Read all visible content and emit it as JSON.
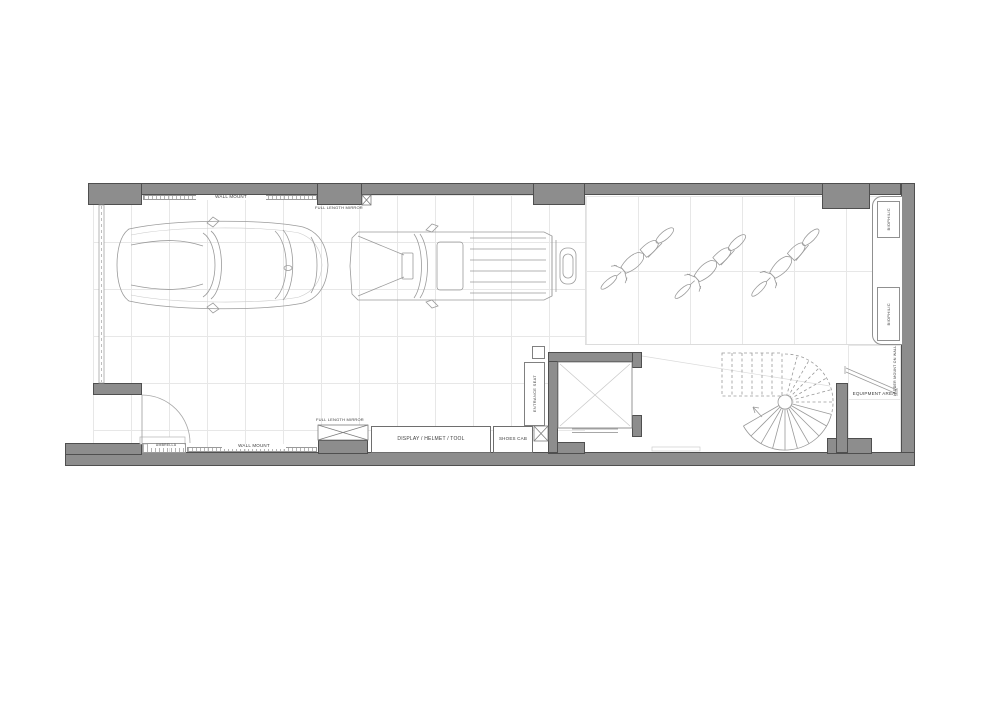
{
  "title": "Garage floor plan",
  "colors": {
    "wall": "#8d8d8d",
    "wall_outline": "#4f4f4f",
    "drawing_line": "#9b9b9b",
    "tile_line": "#e7e7e7",
    "label_text": "#3d3d3d",
    "background": "#ffffff"
  },
  "plan": {
    "top": {
      "wall_mount": "WALL MOUNT",
      "mirror": "FULL LENGTH MIRROR"
    },
    "bottom": {
      "umbrella": "UMBRELLA",
      "wall_mount": "WALL MOUNT",
      "mirror": "FULL LENGTH MIRROR",
      "display_cab": "DISPLAY / HELMET / TOOL",
      "shoes_cab": "SHOES CAB"
    },
    "entrance": {
      "seat": "ENTRANCE SEAT"
    },
    "right": {
      "planters": [
        "BIOPHILIC",
        "BIOPHILIC"
      ],
      "equipment_area": "EQUIPMENT AREA",
      "ladder": "LADDER MOUNT ON WALL"
    },
    "vehicles": [
      "sedan",
      "suv",
      "motorcycle",
      "motorcycle",
      "motorcycle"
    ],
    "features": [
      "garage-door",
      "entry-door",
      "elevator",
      "spiral-staircase",
      "ladder",
      "planters"
    ]
  }
}
